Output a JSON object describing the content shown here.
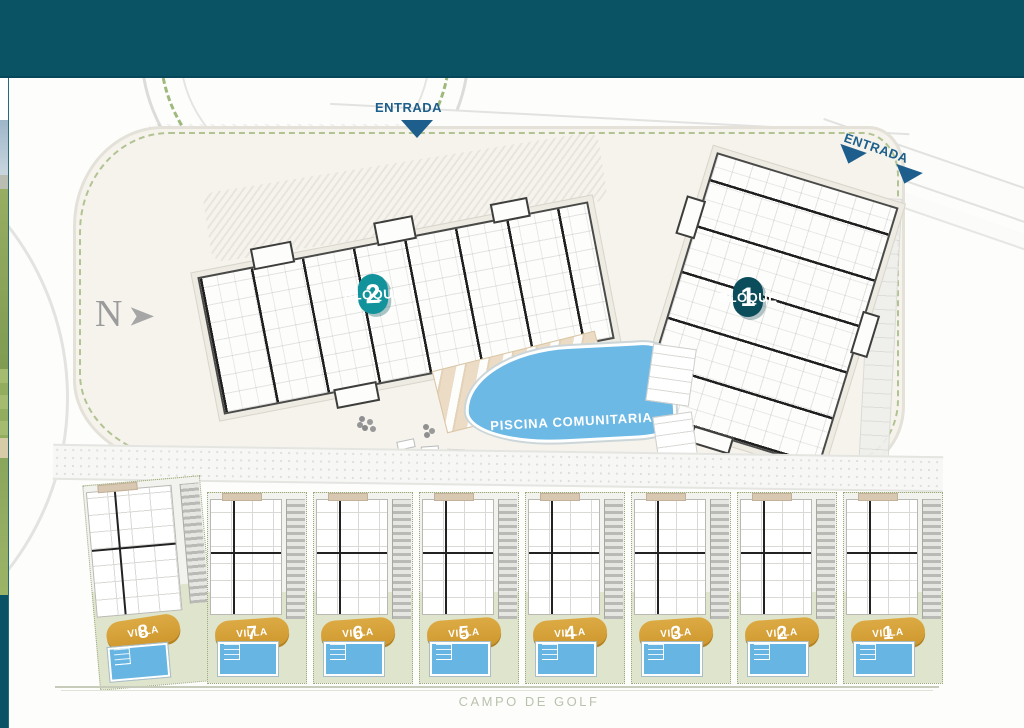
{
  "colors": {
    "topbar": "#0a5365",
    "accent_teal": "#12939b",
    "accent_dark_teal": "#0c4d5b",
    "badge_gold": "#d49d35",
    "pool_blue": "#6db9e5",
    "entrance_blue": "#1d5e8c",
    "hedge_green": "#8fae68",
    "garden_green": "#dfe4cc",
    "golf_text": "#bac2ae",
    "compass_gray": "#9b9b9b"
  },
  "site_plan": {
    "entrance_top": {
      "label": "ENTRADA"
    },
    "entrance_right": {
      "label": "ENTRADA"
    },
    "compass": {
      "label": "N",
      "arrow_icon": "right-arrowhead",
      "arrow_glyph": "➤"
    },
    "blocks": [
      {
        "label": "BLOQUE",
        "number": "2"
      },
      {
        "label": "BLOQUE",
        "number": "1"
      }
    ],
    "pool": {
      "label": "PISCINA COMUNITARIA"
    },
    "villas": [
      {
        "label": "VILLA",
        "number": "8"
      },
      {
        "label": "VILLA",
        "number": "7"
      },
      {
        "label": "VILLA",
        "number": "6"
      },
      {
        "label": "VILLA",
        "number": "5"
      },
      {
        "label": "VILLA",
        "number": "4"
      },
      {
        "label": "VILLA",
        "number": "3"
      },
      {
        "label": "VILLA",
        "number": "2"
      },
      {
        "label": "VILLA",
        "number": "1"
      }
    ],
    "golf_course": {
      "label": "CAMPO DE GOLF"
    }
  }
}
